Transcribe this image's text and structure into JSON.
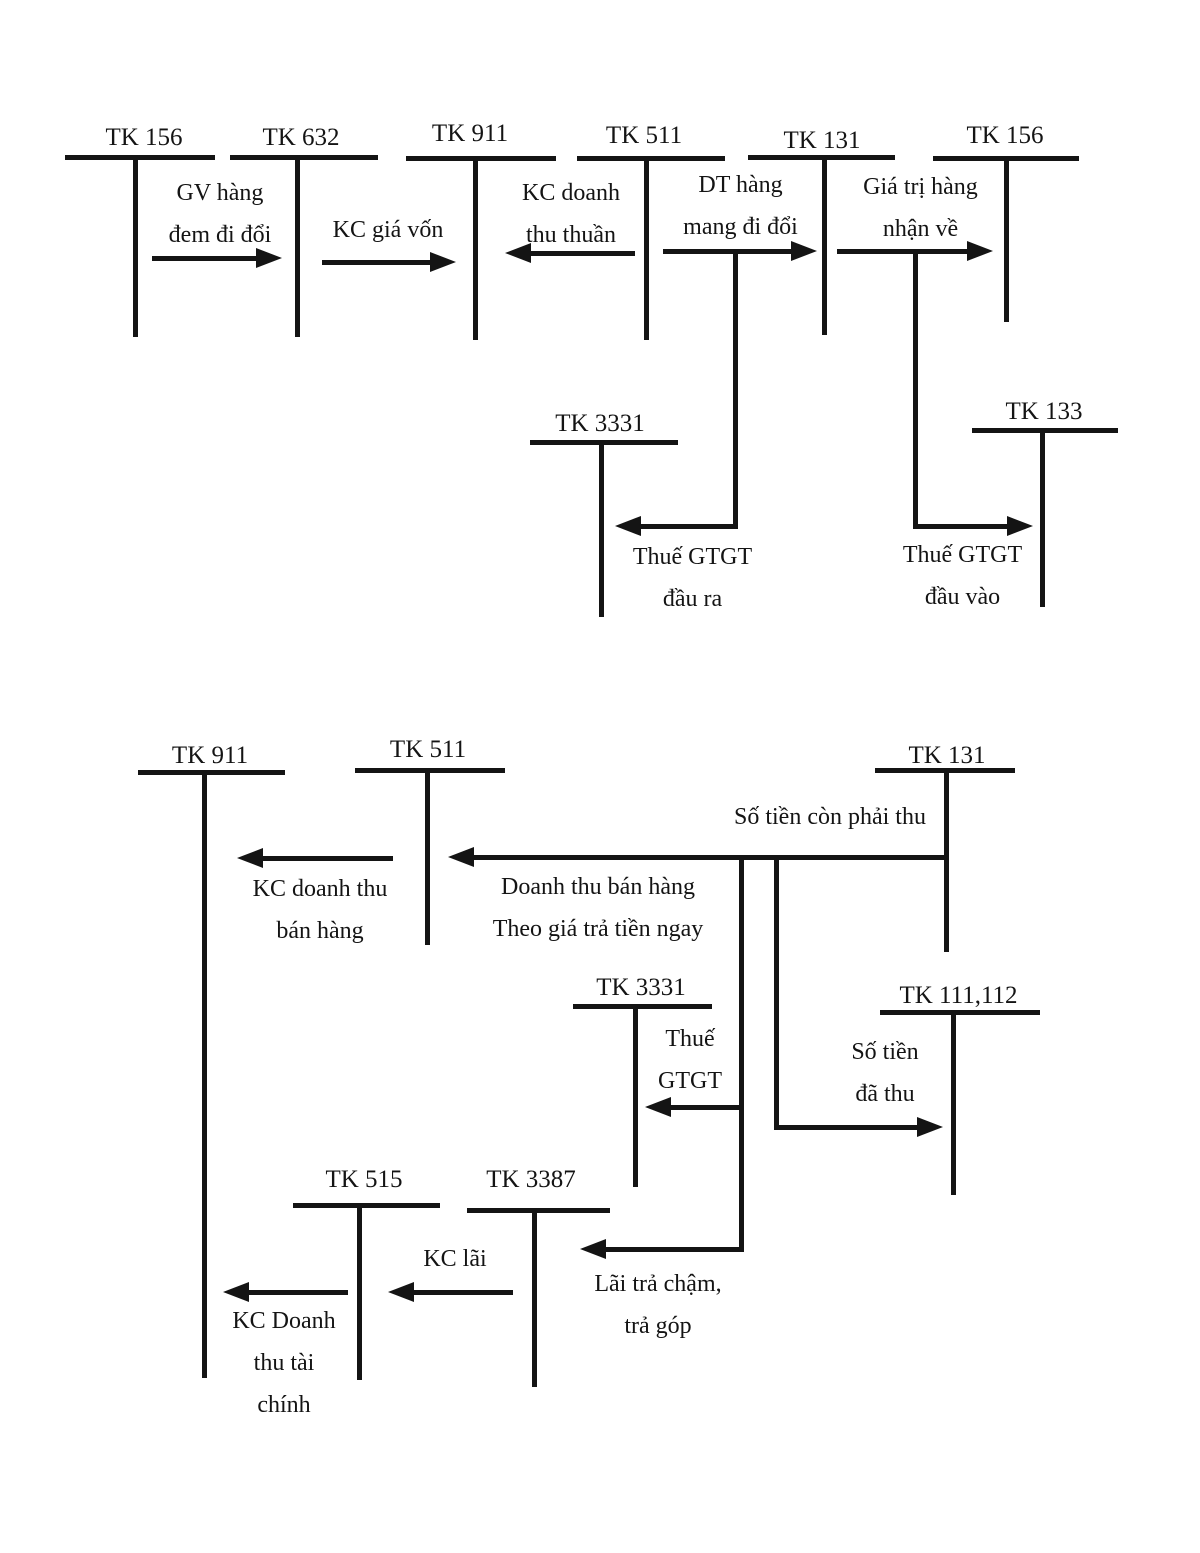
{
  "page": {
    "background": "#ffffff",
    "ink": "#141414"
  },
  "diagram_top": {
    "accounts": {
      "tk156_left": "TK 156",
      "tk632": "TK 632",
      "tk911": "TK 911",
      "tk511": "TK 511",
      "tk131": "TK 131",
      "tk156_right": "TK 156",
      "tk3331": "TK 3331",
      "tk133": "TK 133"
    },
    "flows": {
      "gv_hang": "GV hàng\nđem đi đổi",
      "kc_gia_von": "KC giá vốn",
      "kc_doanh_thu_thuan": "KC doanh\nthu thuần",
      "dt_hang": "DT hàng\nmang đi đổi",
      "gia_tri_hang": "Giá trị hàng\nnhận về",
      "thue_gtgt_dau_ra": "Thuế GTGT\nđầu ra",
      "thue_gtgt_dau_vao": "Thuế GTGT\nđầu vào"
    }
  },
  "diagram_bottom": {
    "accounts": {
      "tk911": "TK 911",
      "tk511": "TK 511",
      "tk131": "TK 131",
      "tk3331": "TK 3331",
      "tk111_112": "TK 111,112",
      "tk515": "TK 515",
      "tk3387": "TK 3387"
    },
    "flows": {
      "so_tien_con_phai_thu": "Số tiền còn phải thu",
      "doanh_thu_ban_hang": "Doanh thu bán hàng\nTheo giá trả tiền ngay",
      "kc_doanh_thu_ban_hang": "KC doanh thu\nbán hàng",
      "thue_gtgt": "Thuế\nGTGT",
      "so_tien_da_thu": "Số tiền\nđã thu",
      "lai_tra_cham": "Lãi trả chậm,\ntrả góp",
      "kc_lai": "KC lãi",
      "kc_doanh_thu_tai_chinh": "KC Doanh\nthu tài\nchính"
    }
  }
}
